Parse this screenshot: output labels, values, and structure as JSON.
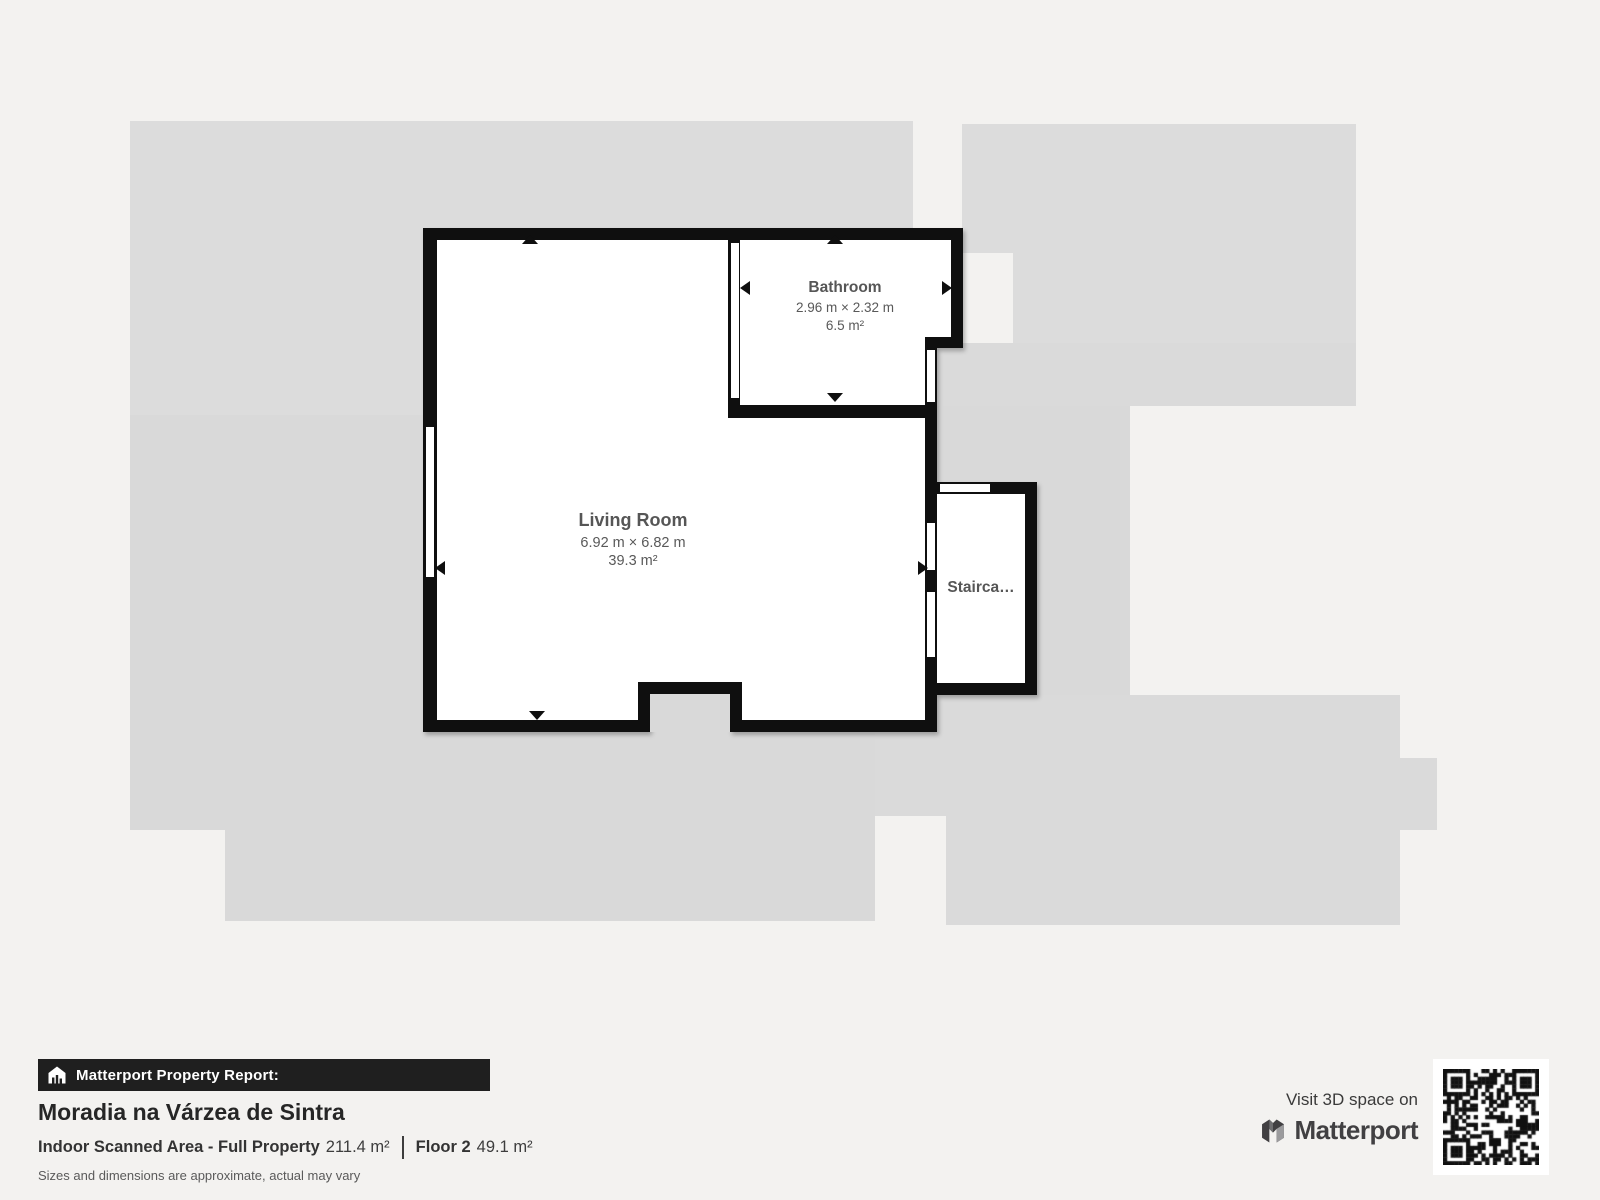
{
  "floorplan": {
    "rooms": [
      {
        "id": "living-room",
        "name": "Living Room",
        "dimensions": "6.92 m × 6.82 m",
        "area": "39.3 m²"
      },
      {
        "id": "bathroom",
        "name": "Bathroom",
        "dimensions": "2.96 m × 2.32 m",
        "area": "6.5 m²"
      },
      {
        "id": "staircase",
        "name": "Stairca…"
      }
    ],
    "colors": {
      "walls": "#0f0f0f",
      "interior": "#ffffff",
      "context_gray": "#d9d9d9",
      "background": "#f3f2f0",
      "label_text": "#565656"
    }
  },
  "report": {
    "header": "Matterport Property Report:",
    "title": "Moradia na Várzea de Sintra",
    "scanned_area_label": "Indoor Scanned Area - Full Property",
    "scanned_area_value": "211.4 m²",
    "floor_label": "Floor 2",
    "floor_value": "49.1 m²",
    "disclaimer": "Sizes and dimensions are approximate, actual may vary"
  },
  "promo": {
    "visit_text": "Visit 3D space on",
    "brand": "Matterport"
  }
}
